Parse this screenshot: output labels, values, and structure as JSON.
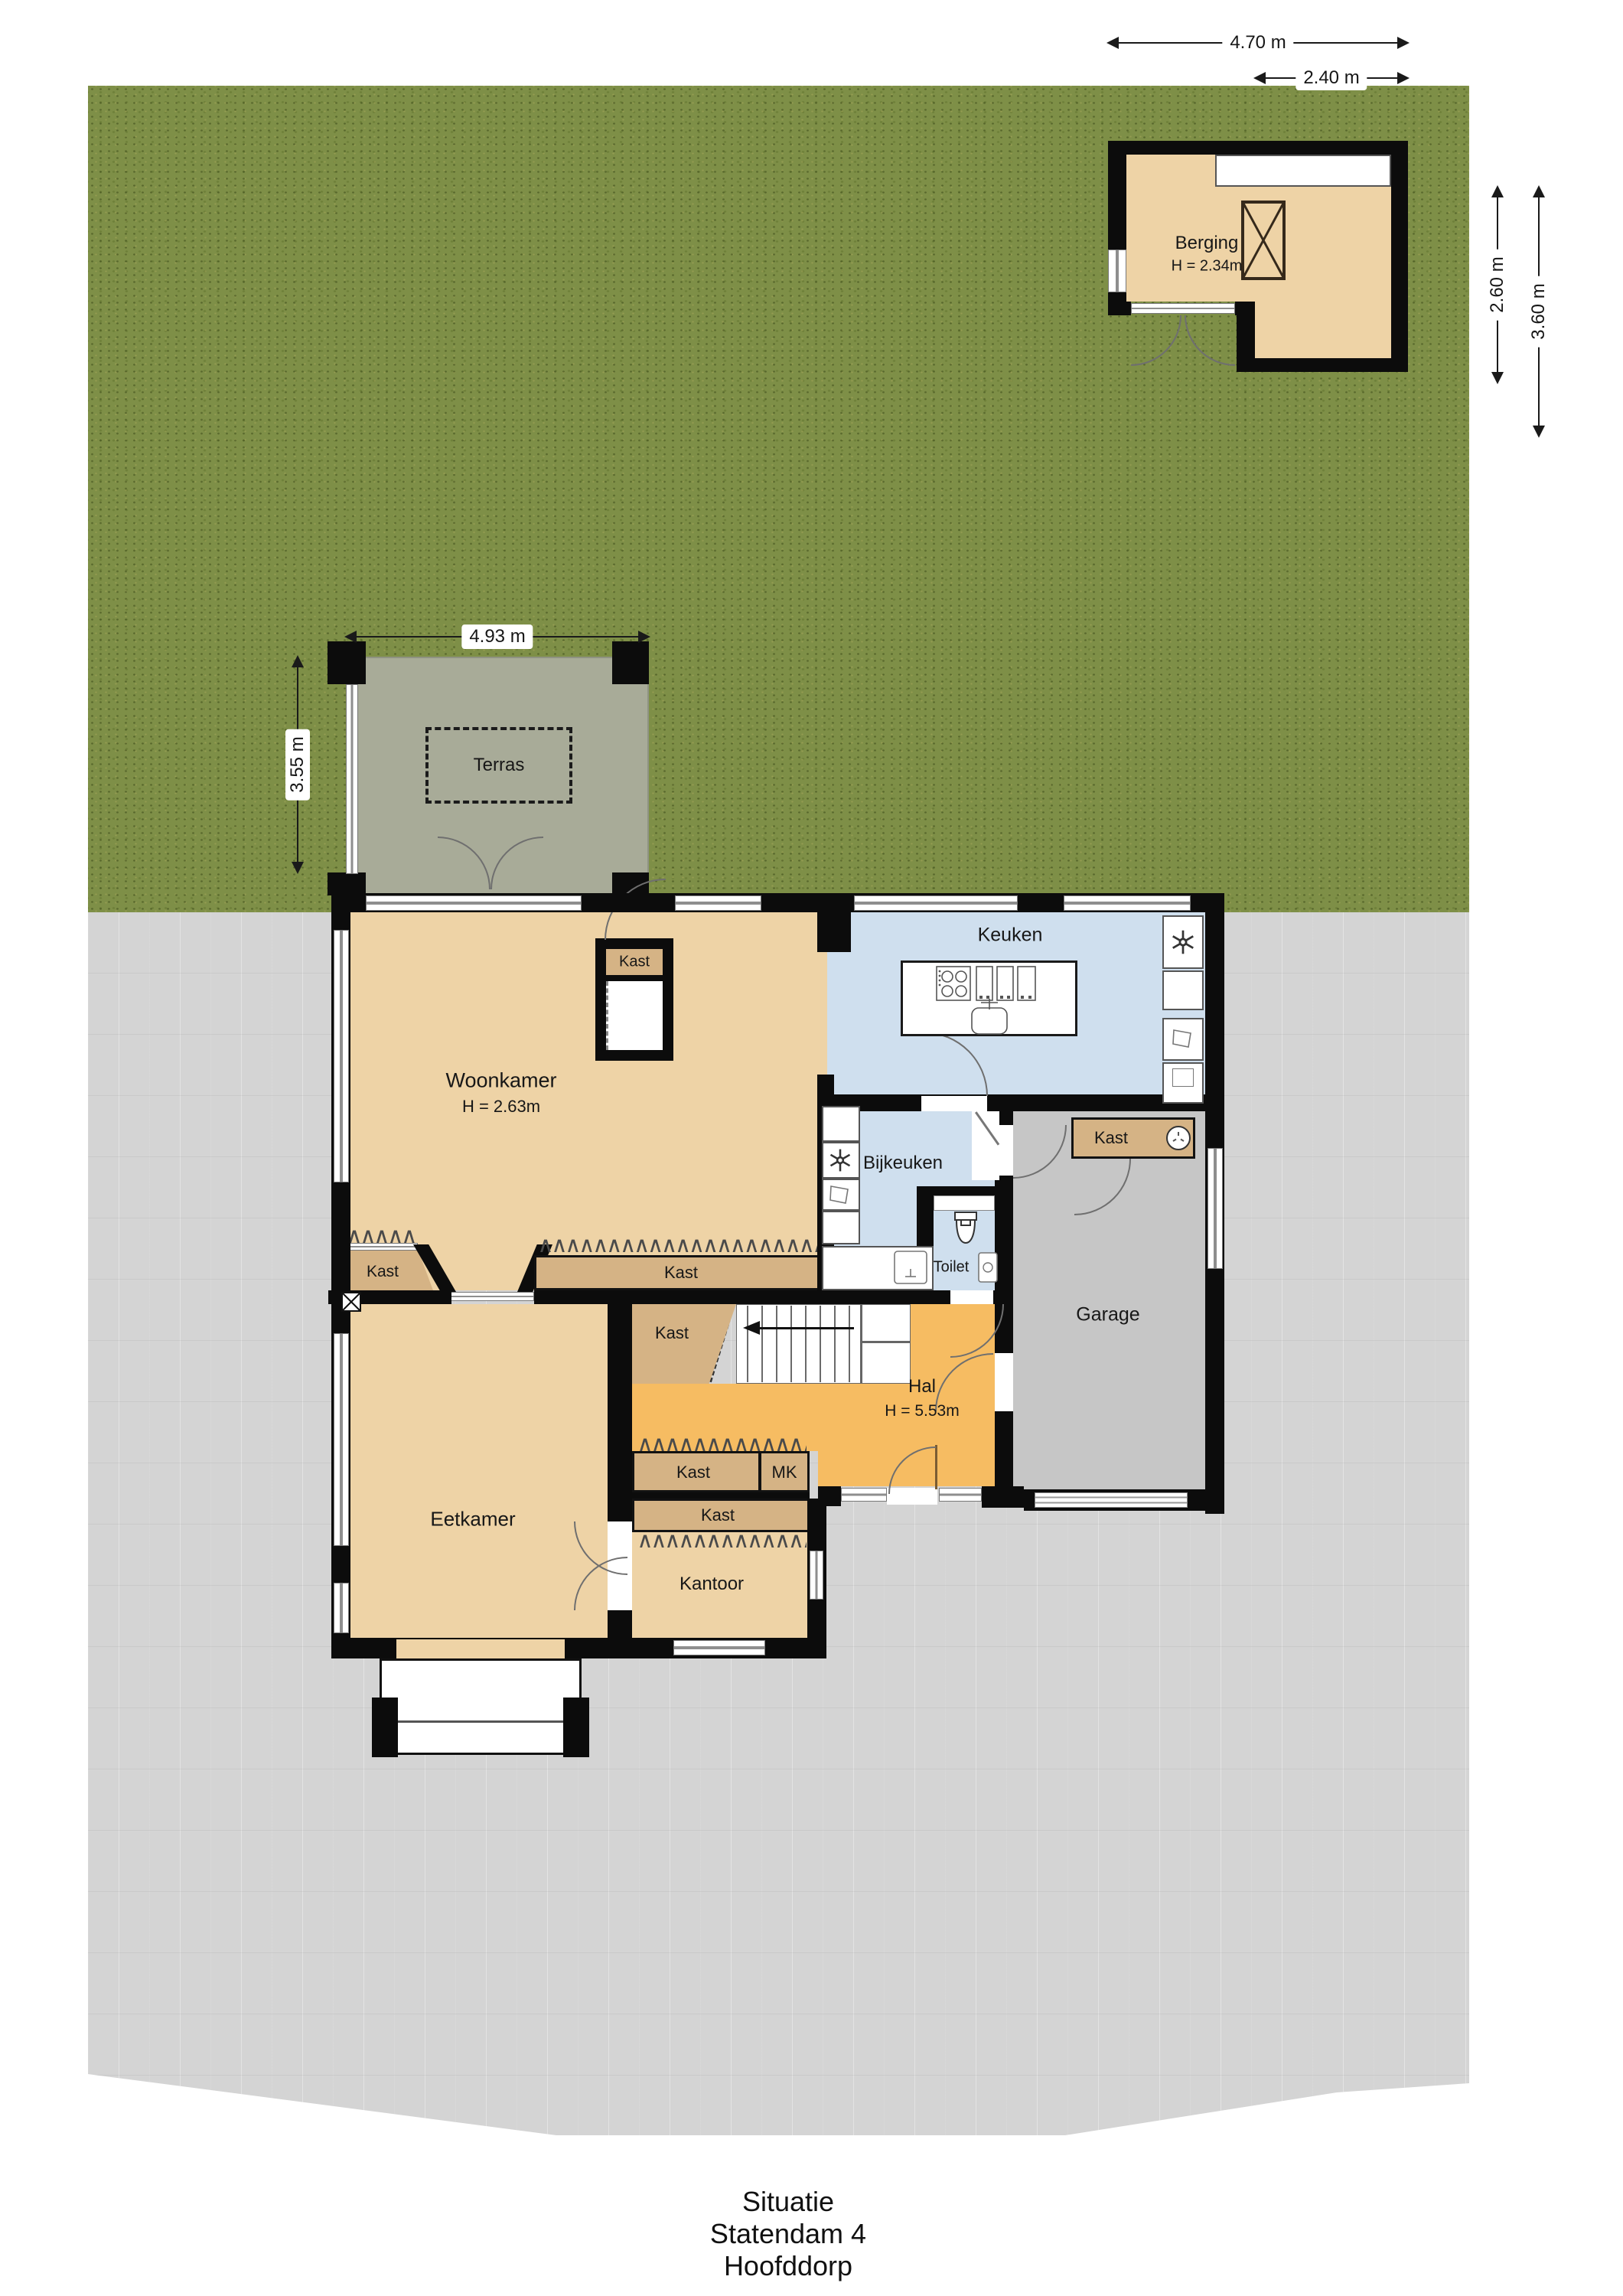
{
  "title": {
    "line1": "Situatie",
    "line2": "Statendam 4",
    "line3": "Hoofddorp"
  },
  "dimensions": {
    "berging_width": "4.70 m",
    "berging_ext_width": "2.40 m",
    "berging_height": "2.60 m",
    "berging_total_height": "3.60 m",
    "terras_width": "4.93 m",
    "terras_depth": "3.55 m"
  },
  "rooms": {
    "berging": {
      "label": "Berging",
      "ceiling": "H = 2.34m"
    },
    "terras": {
      "label": "Terras"
    },
    "woonkamer": {
      "label": "Woonkamer",
      "ceiling": "H = 2.63m"
    },
    "keuken": {
      "label": "Keuken"
    },
    "bijkeuken": {
      "label": "Bijkeuken"
    },
    "toilet": {
      "label": "Toilet"
    },
    "garage": {
      "label": "Garage"
    },
    "hal": {
      "label": "Hal",
      "ceiling": "H = 5.53m"
    },
    "eetkamer": {
      "label": "Eetkamer"
    },
    "kantoor": {
      "label": "Kantoor"
    }
  },
  "closets": {
    "woonkamer_closet": "Kast",
    "woonkamer_left": "Kast",
    "woonkamer_wall": "Kast",
    "hal_stairs": "Kast",
    "hal_row1": "Kast",
    "meter_cupboard": "MK",
    "hal_row2": "Kast",
    "garage_kast": "Kast"
  },
  "colors": {
    "garden": "#7e8f47",
    "paving": "#d4d4d4",
    "terrace": "#a8ab98",
    "room_tan": "#eed3a6",
    "closet_tan": "#d5b385",
    "kitchen_blue": "#cfdfee",
    "hall_orange": "#f6bc62",
    "garage_gray": "#c6c6c6",
    "wall": "#0c0c0c"
  }
}
